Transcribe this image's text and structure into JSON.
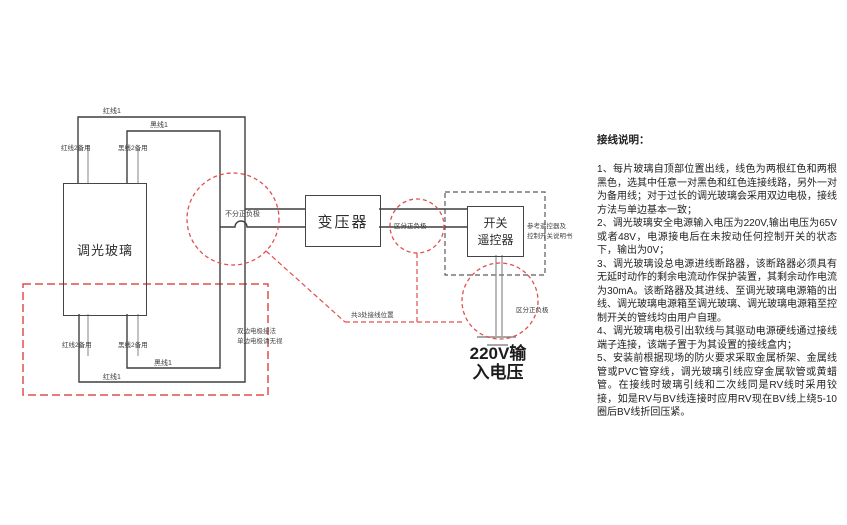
{
  "diagram": {
    "glass_label": "调光玻璃",
    "transformer_label": "变压器",
    "switch_label_line1": "开关",
    "switch_label_line2": "遥控器",
    "switch_note_line1": "参考遥控器及",
    "switch_note_line2": "控制开关说明书",
    "voltage_line1": "220V输",
    "voltage_line2": "入电压",
    "wire_labels": {
      "red1_top": "红线1",
      "black1_top": "黑线1",
      "red2_top": "红线2备用",
      "black2_top": "黑线2备用",
      "red1_bottom": "红线1",
      "black1_bottom": "黑线1",
      "red2_bottom": "红线2备用",
      "black2_bottom": "黑线2备用"
    },
    "junction_no_polarity": "不分正负极",
    "polarity_transformer_out": "区分正负极",
    "polarity_power_in": "区分正负极",
    "wiring_positions_note": "共3处接线位置",
    "double_electrode_note_line1": "双边电极接法",
    "double_electrode_note_line2": "单边电极请无视",
    "colors": {
      "annotation_red": "#e14f4f",
      "wire_dark": "#3f3f3f",
      "wire_spare": "#9a9a9a"
    }
  },
  "instructions": {
    "title": "接线说明：",
    "items": [
      "1、每片玻璃自顶部位置出线，线色为两根红色和两根黑色，选其中任意一对黑色和红色连接线路，另外一对为备用线；对于过长的调光玻璃会采用双边电极，接线方法与单边基本一致；",
      "2、调光玻璃安全电源输入电压为220V,输出电压为65V或者48V，电源接电后在未按动任何控制开关的状态下，输出为0V；",
      "3、调光玻璃设总电源进线断路器，该断路器必须具有无延时动作的剩余电流动作保护装置，其剩余动作电流为30mA。该断路器及其进线、至调光玻璃电源箱的出线、调光玻璃电源箱至调光玻璃、调光玻璃电源箱至控制开关的管线均由用户自理。",
      "4、调光玻璃电极引出软线与其驱动电源硬线通过接线端子连接，该端子置于为其设置的接线盒内；",
      "5、安装前根据现场的防火要求采取金属桥架、金属线管或PVC管穿线，调光玻璃引线应穿金属软管或黄蜡管。在接线时玻璃引线和二次线同是RV线时采用铰接，如是RV与BV线连接时应用RV现在BV线上绕5-10圈后BV线折回压紧。"
    ]
  }
}
